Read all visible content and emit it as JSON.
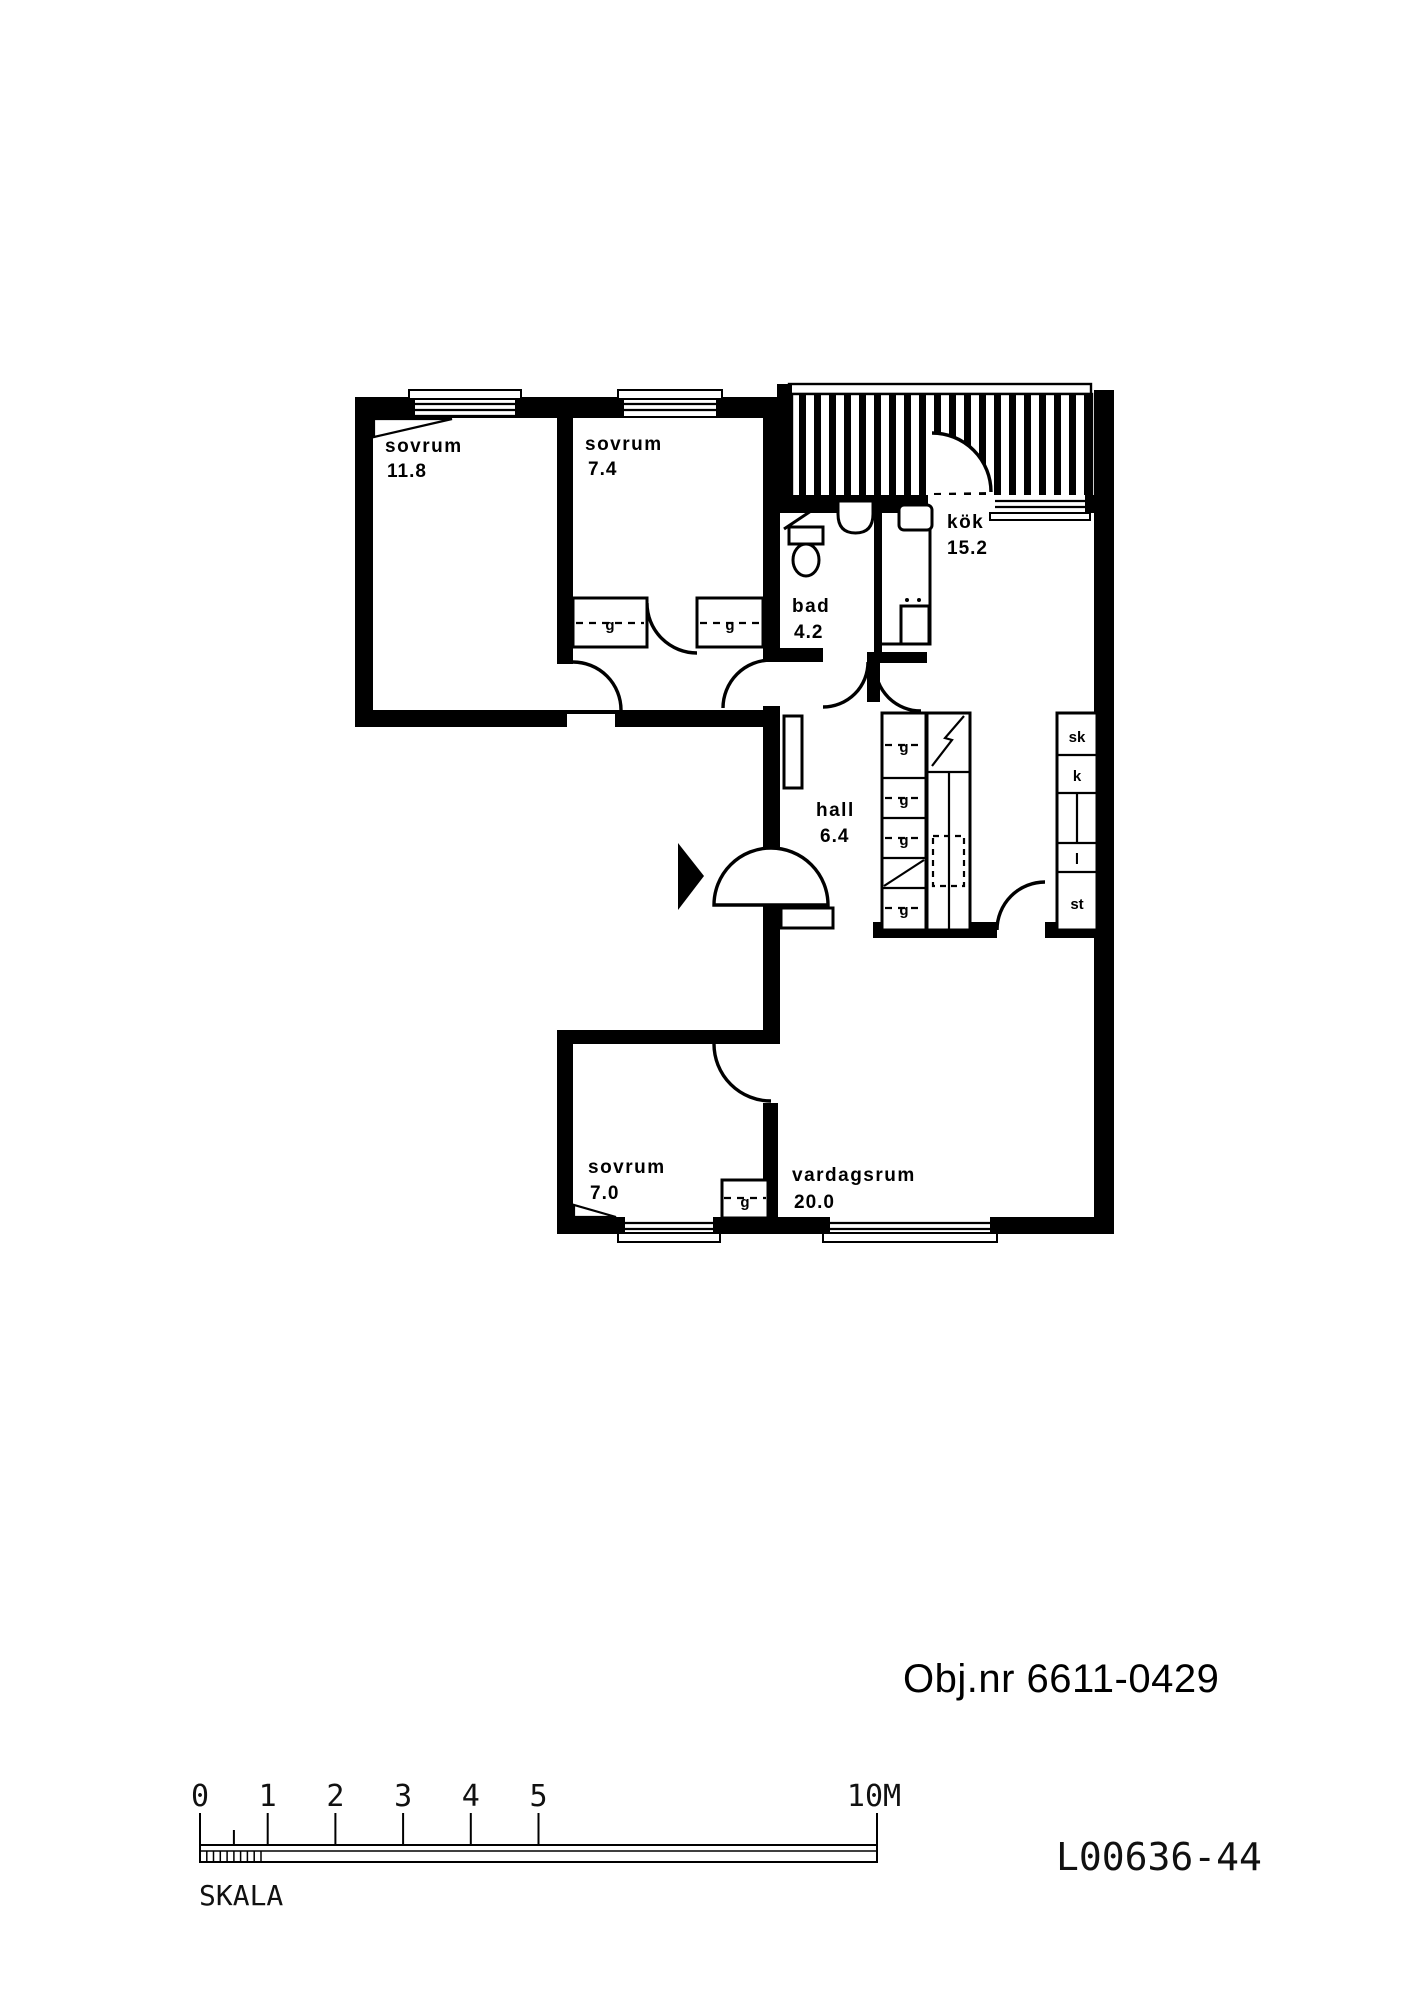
{
  "plan": {
    "rooms": [
      {
        "name": "sovrum",
        "area": "11.8"
      },
      {
        "name": "sovrum",
        "area": "7.4"
      },
      {
        "name": "bad",
        "area": "4.2"
      },
      {
        "name": "kök",
        "area": "15.2"
      },
      {
        "name": "hall",
        "area": "6.4"
      },
      {
        "name": "sovrum",
        "area": "7.0"
      },
      {
        "name": "vardagsrum",
        "area": "20.0"
      }
    ],
    "closet_labels": {
      "garderob": "g",
      "sk": "sk",
      "k": "k",
      "l": "l",
      "st": "st"
    }
  },
  "footer": {
    "object_number": "Obj.nr 6611-0429",
    "drawing_number": "L00636-44",
    "scale": {
      "label": "SKALA",
      "ticks": [
        "0",
        "1",
        "2",
        "3",
        "4",
        "5"
      ],
      "end": "10M"
    }
  },
  "colors": {
    "ink": "#000000",
    "paper": "#ffffff"
  }
}
